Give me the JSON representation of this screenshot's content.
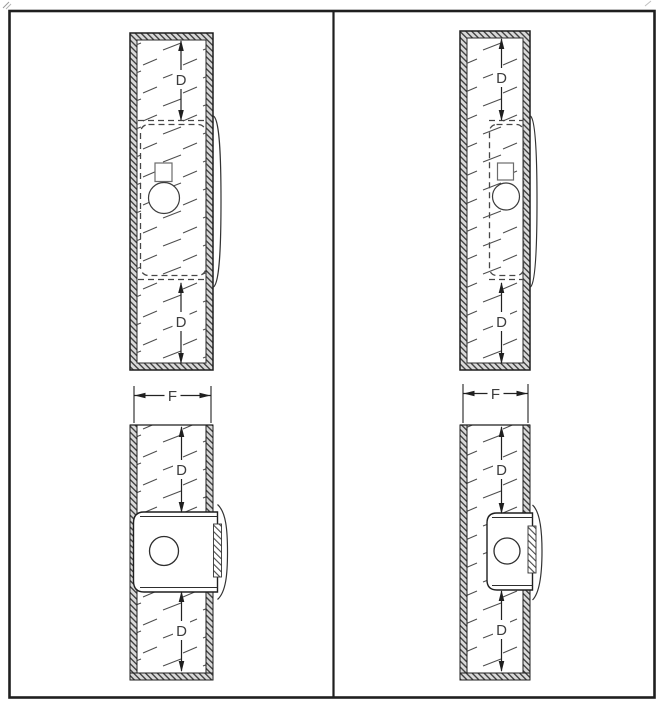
{
  "drawing": {
    "sheet": "technical-drawing",
    "colors": {
      "line": "#1f1f1f",
      "dashed_line": "#474747",
      "wall_hatch_fill": "#d9d9d9",
      "paper": "#ffffff"
    },
    "panels": {
      "top_left": {
        "dims": [
          "D",
          "D"
        ]
      },
      "top_right": {
        "dims": [
          "D",
          "D"
        ]
      },
      "bottom_left": {
        "dims": [
          "F",
          "D",
          "D"
        ]
      },
      "bottom_right": {
        "dims": [
          "F",
          "D",
          "D"
        ]
      }
    }
  }
}
